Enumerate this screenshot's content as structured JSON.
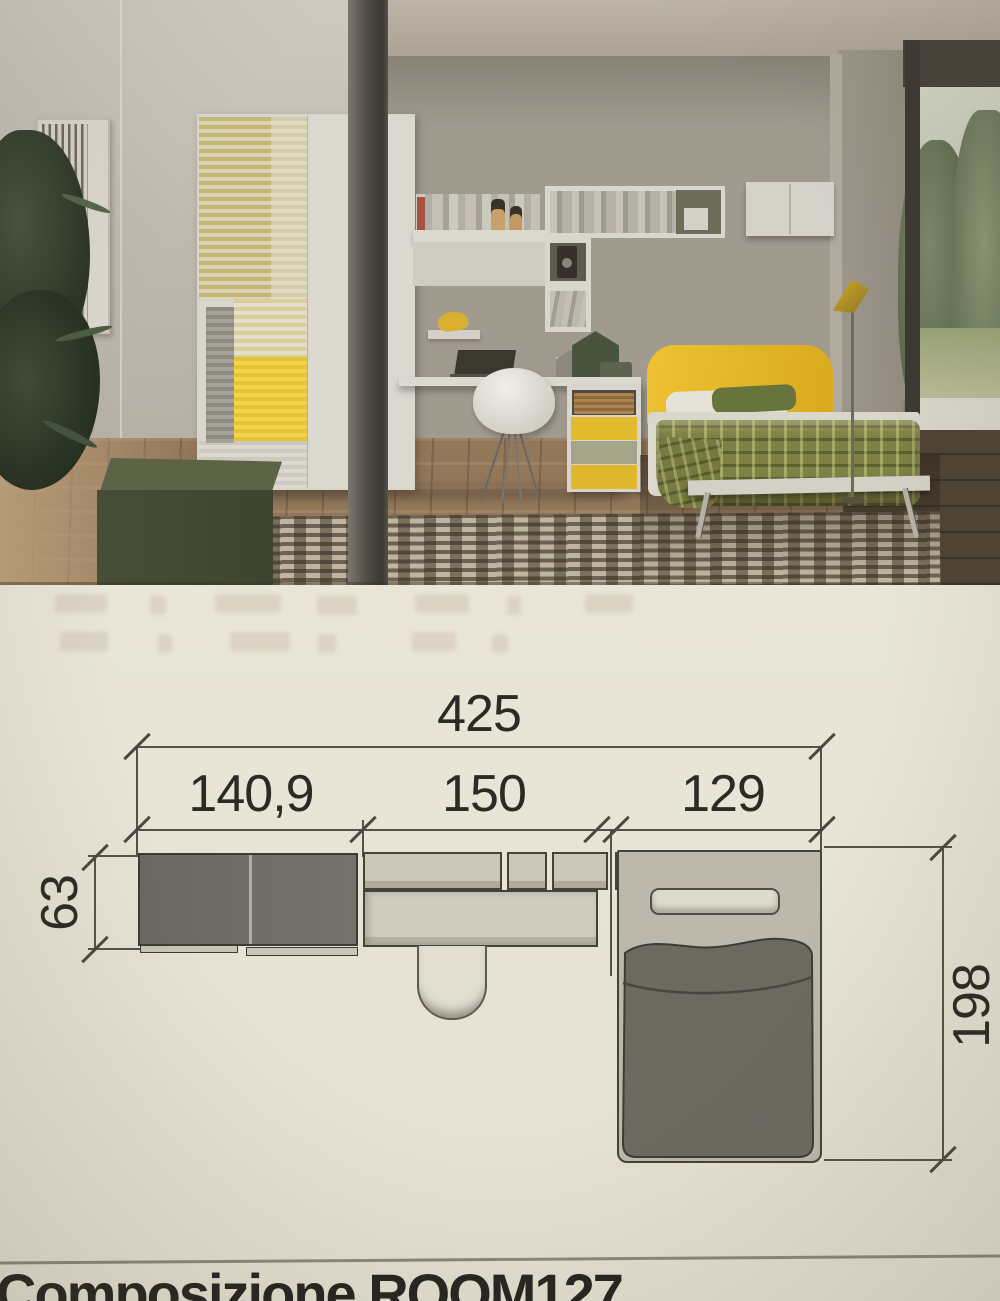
{
  "plan": {
    "dim_total": "425",
    "dim_wardrobe": "140,9",
    "dim_desk": "150",
    "dim_bed_width": "129",
    "dim_depth": "63",
    "dim_bed_length": "198"
  },
  "footer": {
    "title": "Composizione ROOM127"
  },
  "colors": {
    "accent_yellow": "#e7c531",
    "plan_dark_gray": "#6e6d65",
    "plan_light_gray": "#cbc8b9",
    "paper": "#e9e6d8"
  }
}
